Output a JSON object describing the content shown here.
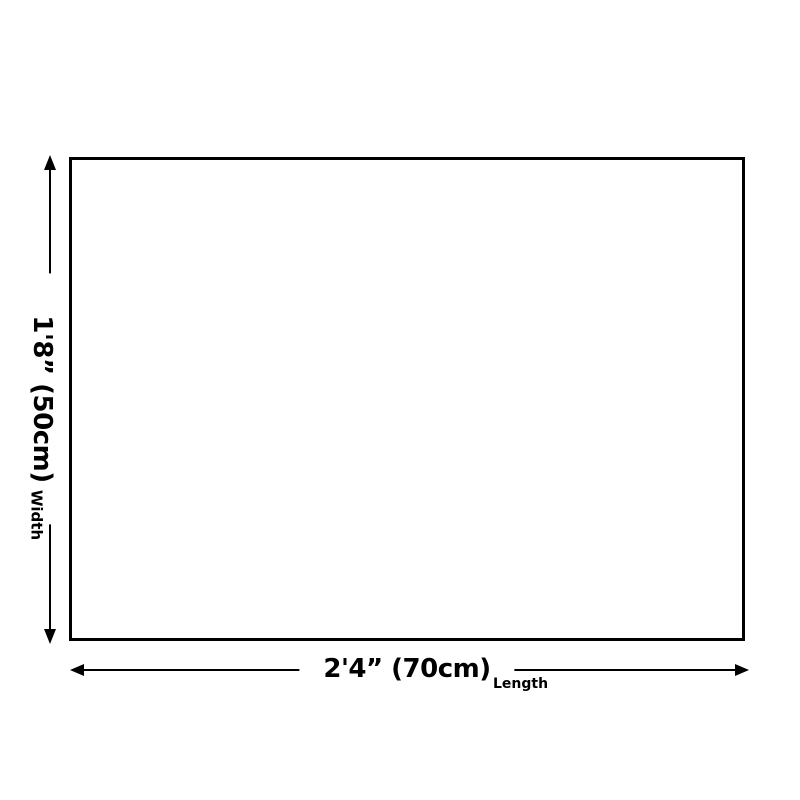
{
  "diagram": {
    "background_color": "#ffffff",
    "stroke_color": "#000000",
    "text_color": "#000000",
    "width_dimension": {
      "value": "1'8” (50cm)",
      "label": "Width"
    },
    "length_dimension": {
      "value": "2'4” (70cm)",
      "label": "Length"
    }
  }
}
